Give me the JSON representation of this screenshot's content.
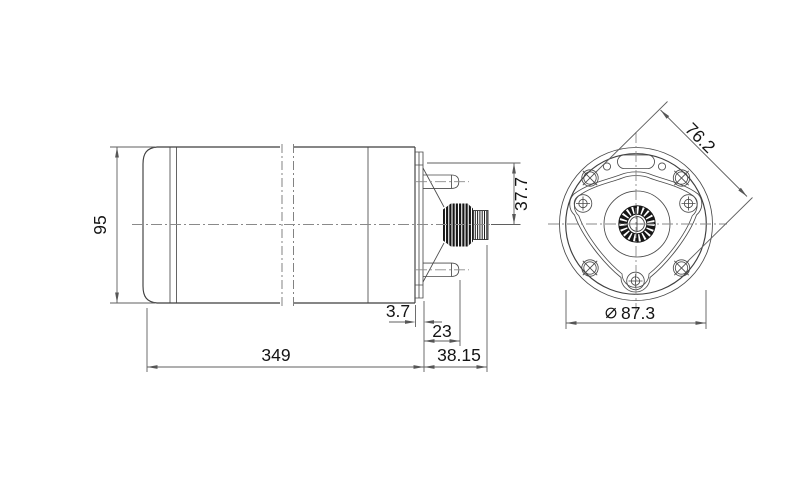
{
  "drawing": {
    "type": "technical-dimension-drawing",
    "views": {
      "side_view": "motor-side-elevation",
      "front_view": "motor-end-elevation"
    },
    "dimensions": {
      "body_height": "95",
      "body_length": "349",
      "flange_offset": "3.7",
      "stud_length": "23",
      "shaft_extension": "38.15",
      "terminal_to_axis": "37.7",
      "mount_hole_spacing": "76.2",
      "diameter_symbol": "⌀",
      "flange_diameter": "87.3"
    },
    "colors": {
      "background": "#ffffff",
      "object_line": "#3f3f3f",
      "dimension_line": "#5f5f5f",
      "centerline": "#8a8a8a",
      "text": "#141414",
      "shaft_knurl_fill": "#161616"
    }
  }
}
